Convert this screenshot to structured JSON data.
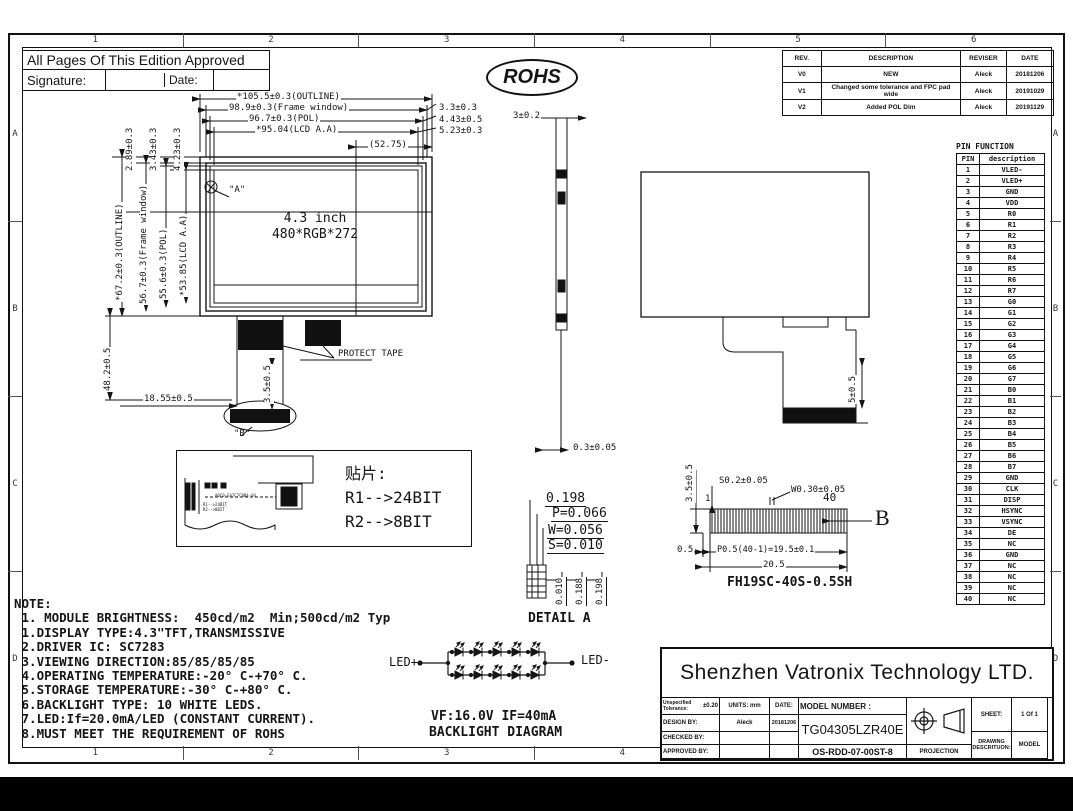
{
  "approval": {
    "title": "All Pages Of This Edition Approved",
    "signature_label": "Signature:",
    "date_label": "Date:"
  },
  "rohs": "ROHS",
  "revision_table": {
    "headers": [
      "REV.",
      "DESCRIPTION",
      "REVISER",
      "DATE"
    ],
    "rows": [
      [
        "V0",
        "NEW",
        "Aleck",
        "20181206"
      ],
      [
        "V1",
        "Changed some tolerance and FPC pad wide",
        "Aleck",
        "20191029"
      ],
      [
        "V2",
        "Added POL Dim",
        "Aleck",
        "20191129"
      ]
    ]
  },
  "front_view": {
    "size": "4.3 inch",
    "resolution": "480*RGB*272",
    "dim_outline_w": "*105.5±0.3(OUTLINE)",
    "dim_frame_w": "98.9±0.3(Frame window)",
    "dim_pol_w": "96.7±0.3(POL)",
    "dim_aa_w": "*95.04(LCD A.A)",
    "dim_half": "(52.75)",
    "dim_r1": "3.3±0.3",
    "dim_r2": "4.43±0.5",
    "dim_r3": "5.23±0.3",
    "dim_t1": "2.89±0.3",
    "dim_t2": "3.43±0.3",
    "dim_t3": "4.23±0.3",
    "dim_outline_h": "*67.2±0.3(OUTLINE)",
    "dim_frame_h": "56.7±0.3(Frame window)",
    "dim_pol_h": "55.6±0.3(POL)",
    "dim_aa_h": "*53.85(LCD A.A)",
    "dim_fpc_len": "48.2±0.5",
    "dim_fpc_off": "18.55±0.5",
    "dim_tape": "3.5±0.5",
    "protect_tape": "PROTECT TAPE",
    "callout_a": "\"A\"",
    "callout_b": "\"B\""
  },
  "side_view": {
    "dim_top": "3±0.2",
    "dim_bottom": "0.3±0.05"
  },
  "rear_view": {
    "dim_pad": "5±0.5"
  },
  "pin_table": {
    "title": "PIN FUNCTION",
    "headers": [
      "PIN",
      "description"
    ],
    "rows": [
      [
        "1",
        "VLED-"
      ],
      [
        "2",
        "VLED+"
      ],
      [
        "3",
        "GND"
      ],
      [
        "4",
        "VDD"
      ],
      [
        "5",
        "R0"
      ],
      [
        "6",
        "R1"
      ],
      [
        "7",
        "R2"
      ],
      [
        "8",
        "R3"
      ],
      [
        "9",
        "R4"
      ],
      [
        "10",
        "R5"
      ],
      [
        "11",
        "R6"
      ],
      [
        "12",
        "R7"
      ],
      [
        "13",
        "G0"
      ],
      [
        "14",
        "G1"
      ],
      [
        "15",
        "G2"
      ],
      [
        "16",
        "G3"
      ],
      [
        "17",
        "G4"
      ],
      [
        "18",
        "G5"
      ],
      [
        "19",
        "G6"
      ],
      [
        "20",
        "G7"
      ],
      [
        "21",
        "B0"
      ],
      [
        "22",
        "B1"
      ],
      [
        "23",
        "B2"
      ],
      [
        "24",
        "B3"
      ],
      [
        "25",
        "B4"
      ],
      [
        "26",
        "B5"
      ],
      [
        "27",
        "B6"
      ],
      [
        "28",
        "B7"
      ],
      [
        "29",
        "GND"
      ],
      [
        "30",
        "CLK"
      ],
      [
        "31",
        "DISP"
      ],
      [
        "32",
        "HSYNC"
      ],
      [
        "33",
        "VSYNC"
      ],
      [
        "34",
        "DE"
      ],
      [
        "35",
        "NC"
      ],
      [
        "36",
        "GND"
      ],
      [
        "37",
        "NC"
      ],
      [
        "38",
        "NC"
      ],
      [
        "39",
        "NC"
      ],
      [
        "40",
        "NC"
      ]
    ]
  },
  "smt": {
    "title": "贴片:",
    "r1": "R1-->24BIT",
    "r2": "R2-->8BIT",
    "tiny_chip": "A0C0-EA7C7C0B4-04",
    "tiny_r1": "R1-->24BIT",
    "tiny_r2": "R2-->8BIT"
  },
  "detail_a": {
    "d1": "0.198",
    "d2": "P=0.066",
    "d3": "W=0.056",
    "d4": "S=0.010",
    "v1": "0.010",
    "v2": "0.188",
    "v3": "0.198",
    "caption": "DETAIL  A"
  },
  "connector": {
    "dim_h": "3.5±0.5",
    "pin_first": "1",
    "pin_last": "40",
    "dim_s": "S0.2±0.05",
    "dim_w": "W0.30±0.05",
    "dim_end": "0.5",
    "dim_pitch": "P0.5(40-1)=19.5±0.1",
    "dim_total": "20.5",
    "callout_b": "B",
    "part": "FH19SC-40S-0.5SH"
  },
  "notes": {
    "title": "NOTE:",
    "lines": [
      " 1. MODULE BRIGHTNESS:  450cd/m2  Min;500cd/m2 Typ",
      " 1.DISPLAY TYPE:4.3\"TFT,TRANSMISSIVE",
      " 2.DRIVER IC: SC7283",
      " 3.VIEWING DIRECTION:85/85/85/85",
      " 4.OPERATING TEMPERATURE:-20° C-+70° C.",
      " 5.STORAGE TEMPERATURE:-30° C-+80° C.",
      " 6.BACKLIGHT TYPE: 10 WHITE LEDS.",
      " 7.LED:If=20.0mA/LED (CONSTANT CURRENT).",
      " 8.MUST MEET THE REQUIREMENT OF ROHS"
    ]
  },
  "backlight": {
    "led_plus": "LED+",
    "led_minus": "LED-",
    "spec": "VF:16.0V IF=40mA",
    "caption": "BACKLIGHT DIAGRAM"
  },
  "title_block": {
    "company": "Shenzhen Vatronix Technology LTD.",
    "tolerance_label": "Unspecified Tolerance:",
    "tolerance_value": "±0.20",
    "units": "UNITS: mm",
    "date_label": "DATE:",
    "model_label": "MODEL NUMBER :",
    "model": "TG04305LZR40E",
    "design_label": "DESIGN   BY:",
    "designer": "Aleck",
    "design_date": "20181206",
    "checked_label": "CHECKED  BY:",
    "approved_label": "APPROVED BY:",
    "doc_number": "OS-RDD-07-00ST-8",
    "projection_label": "PROJECTION",
    "sheet_label": "SHEET:",
    "sheet_value": "1 Of 1",
    "drawing_label": "DRAWING DESCRITUON:",
    "model_word": "MODEL"
  },
  "zones": {
    "cols": [
      "1",
      "2",
      "3",
      "4",
      "5",
      "6"
    ],
    "rows": [
      "A",
      "B",
      "C",
      "D"
    ]
  }
}
